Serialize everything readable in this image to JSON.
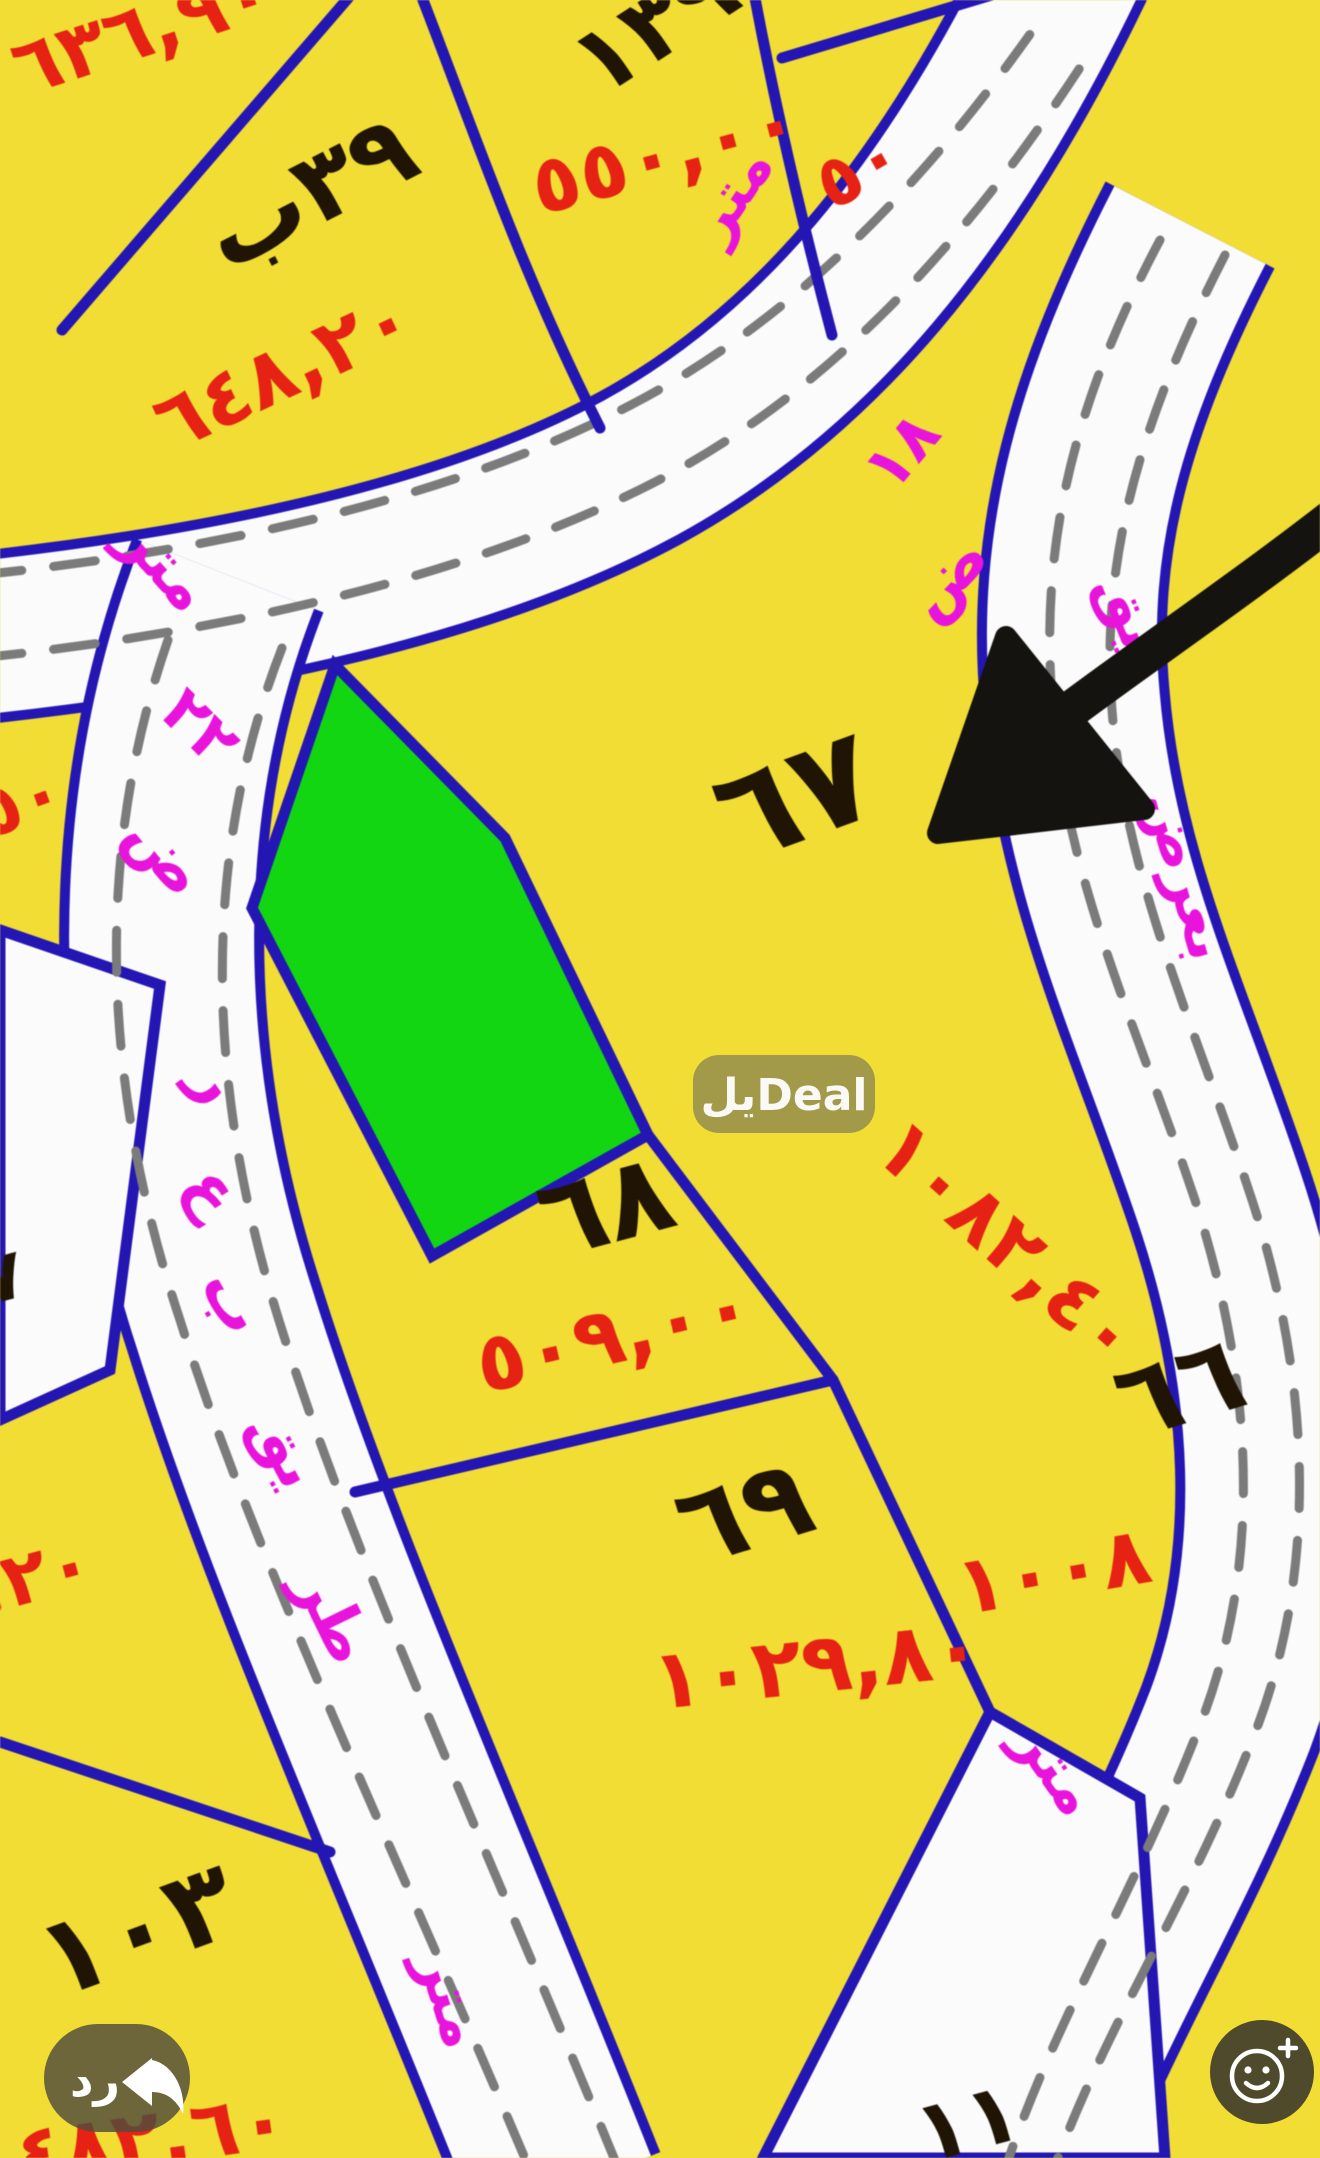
{
  "watermark": {
    "text": "يلDeal"
  },
  "actions": {
    "reply_label": "رد"
  },
  "map": {
    "colors": {
      "parcel_yellow": "#f0dd3a",
      "road_white": "#fbfbfb",
      "border_blue": "#2417ad",
      "area_red": "#df2415",
      "street_pink": "#e316d6",
      "number_black": "#201505",
      "highlight_green": "#17d417",
      "dash_gray": "#7b7b7b",
      "arrow_black": "#151310"
    },
    "plots": [
      {
        "id": "top-left-cut",
        "number": "",
        "area": "٦٣٦,٩٠"
      },
      {
        "id": "39b",
        "number": "٣٩ب",
        "area": "٦٤٨,٢٠"
      },
      {
        "id": "139",
        "number": "١٣٩",
        "area": "٥٥٠,٠٠"
      },
      {
        "id": "top-right-cut",
        "number": "",
        "area": "٥٠"
      },
      {
        "id": "67",
        "number": "٦٧",
        "area": "١٠٨٢,٤٠"
      },
      {
        "id": "68",
        "number": "٦٨",
        "area": "٥٠٩,٠٠"
      },
      {
        "id": "69",
        "number": "٦٩",
        "area": "١٠٢٩,٨٠"
      },
      {
        "id": "66",
        "number": "٦٦",
        "area": "١٠٠٨"
      },
      {
        "id": "103",
        "number": "١٠٣",
        "area": "٤٨٢,٦٠"
      },
      {
        "id": "left-edge-upper",
        "number": "",
        "area": "٥٠"
      },
      {
        "id": "left-edge-lower",
        "number": "٧",
        "area": ",٢٠"
      },
      {
        "id": "bottom-cut",
        "number": "١١",
        "area": ""
      }
    ],
    "streets": [
      {
        "id": "left",
        "label": "طريق بعرض ٢٢ متر",
        "fragments": [
          "متر",
          "٢٢",
          "ض",
          "ر",
          "ع",
          "ب",
          "يق",
          "طر"
        ]
      },
      {
        "id": "top",
        "label": "عرض ١٨ متر",
        "fragments": [
          "متر",
          "١٨",
          "ض"
        ]
      },
      {
        "id": "right",
        "label": "طريق بعرض",
        "fragments": [
          "يق",
          "بعرض",
          "متر"
        ]
      },
      {
        "id": "bottom",
        "label": "متر",
        "fragments": [
          "متر"
        ]
      }
    ]
  }
}
